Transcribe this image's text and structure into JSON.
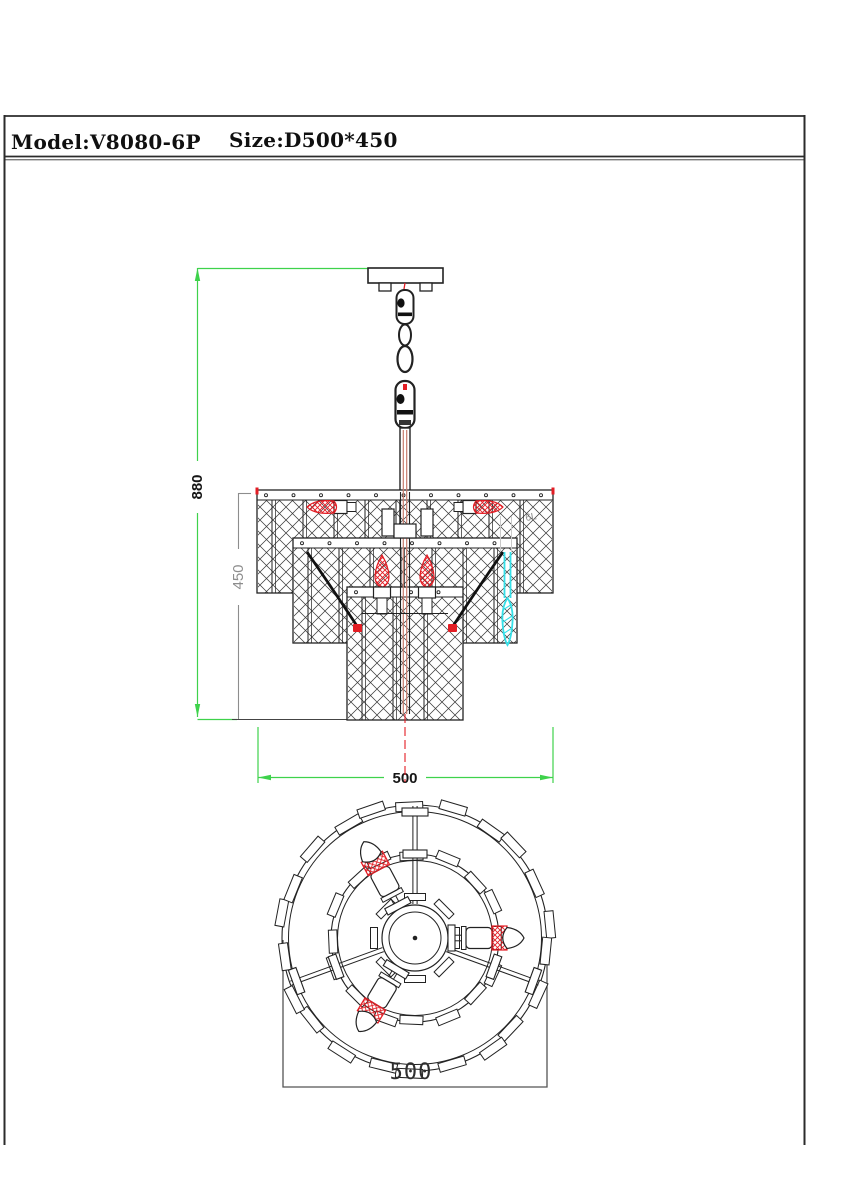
{
  "title_block": {
    "model_label": "Model:V8080-6P",
    "size_label": "Size:D500*450"
  },
  "front_view": {
    "view": "front-elevation-of-chandelier",
    "dim_overall_height": "880",
    "dim_body_height": "450",
    "dim_width": "500",
    "part_note": "6L"
  },
  "top_view": {
    "view": "plan-view-of-chandelier",
    "dim_width": "500"
  },
  "colors": {
    "dimension_green": "#3ed24b",
    "dimension_gray": "#8d8d8d",
    "accent_red": "#e31d24",
    "highlight_cyan": "#35e0e8",
    "wire_salmon": "#c77c6d"
  }
}
